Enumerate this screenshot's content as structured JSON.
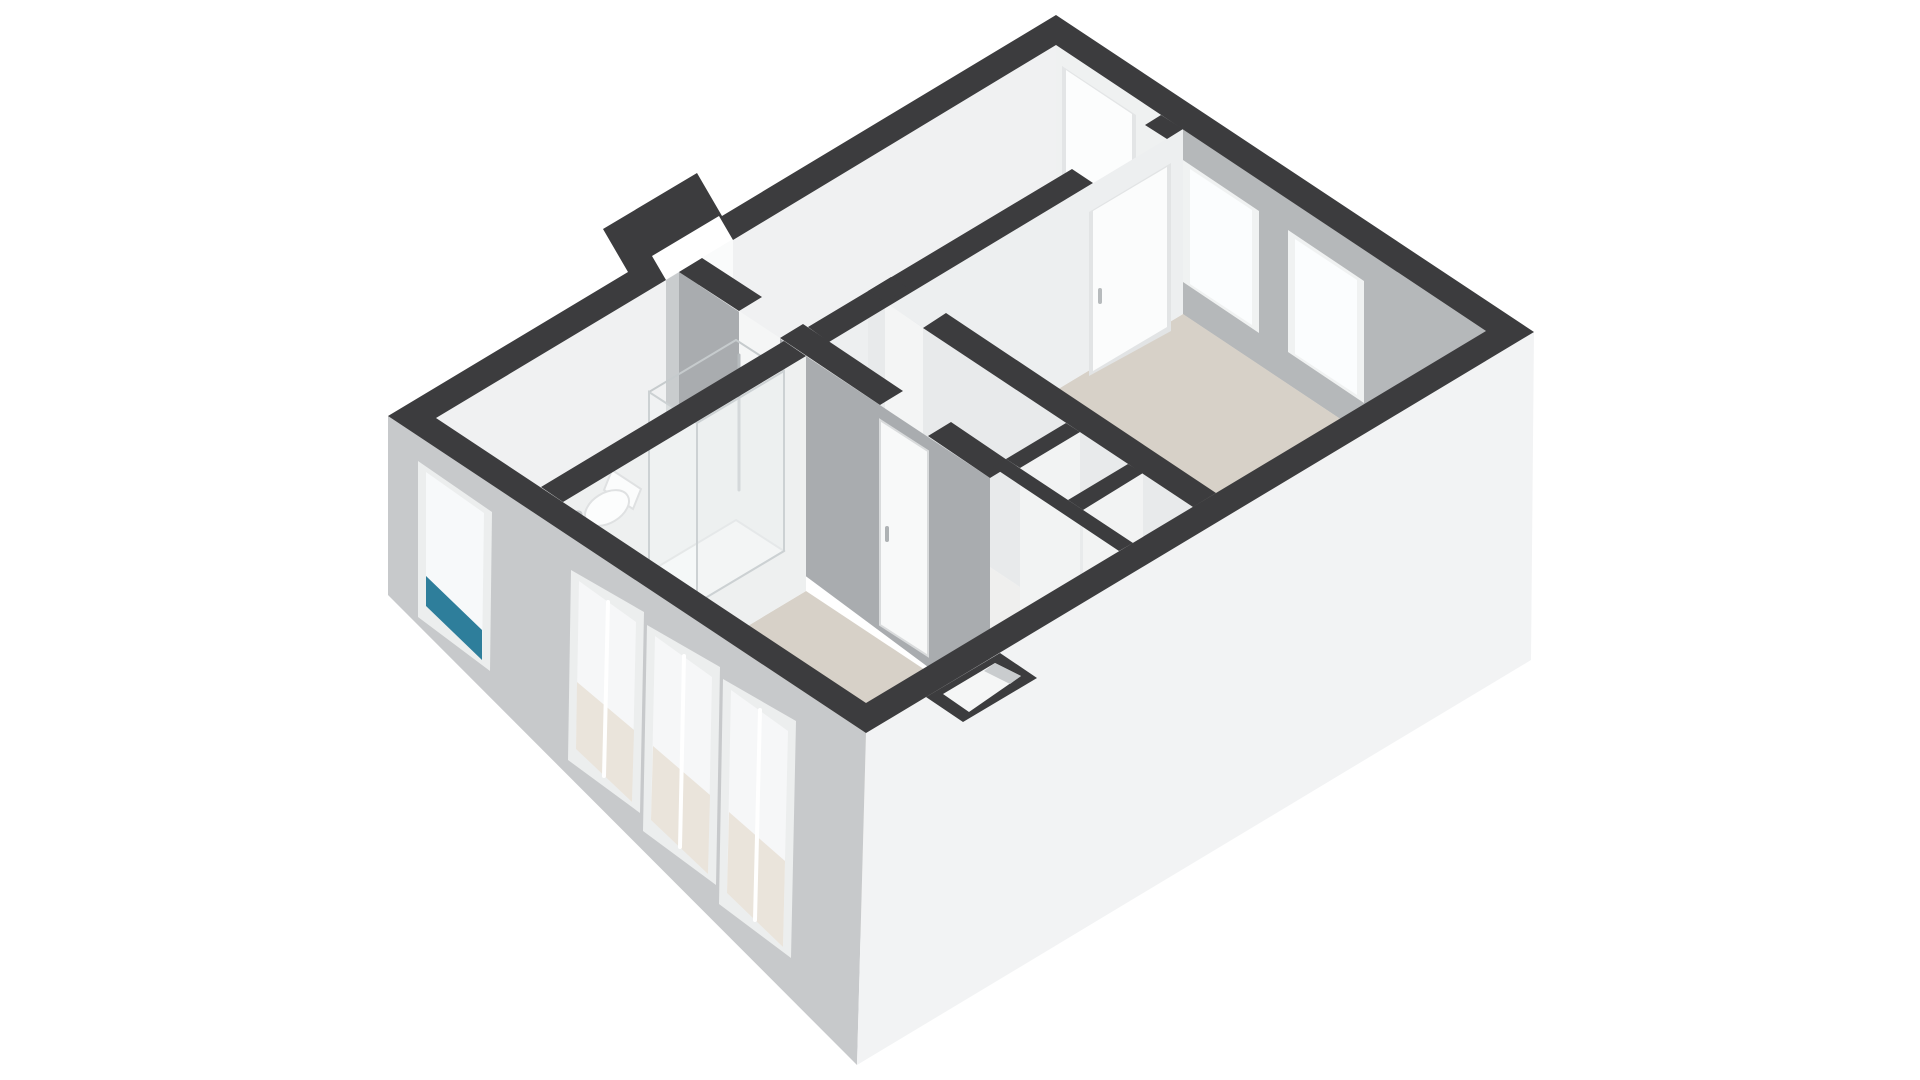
{
  "meta": {
    "description": "3D isometric floor plan render of a small apartment (two rooms, living room, bathroom with shower, bathtub and toilet), dark cut wall caps, beige floors, white background",
    "background": "#ffffff"
  },
  "colors": {
    "wall_cap": "#3c3c3e",
    "facade_shaded": "#c7c9cb",
    "facade_lit": "#f2f3f4",
    "inner_wall_lit": "#eff1f1",
    "inner_wall_shaded": "#aaadb0",
    "floor_beige": "#d7d1c8",
    "floor_white": "#f1f1f0",
    "window_frame": "#eceeee",
    "glass": "#f7f9fa",
    "accent_teal": "#2e7e9b",
    "door_leaf": "#fcfdfd"
  },
  "scene": {
    "width": 1920,
    "height": 1080,
    "shapes": [
      {
        "name": "nw-wall-inner-face",
        "type": "polygon",
        "points": "1056,45 436,418 436,628 1056,215",
        "fill": "#f0f1f2"
      },
      {
        "name": "nw-wall-niche-opening",
        "type": "polygon",
        "points": "733,239 666,280 666,460 733,419",
        "fill": "#fafbfb"
      },
      {
        "name": "nw-wall-niche-shade",
        "type": "polygon",
        "points": "699,260 666,280 666,460 699,440",
        "fill": "#c9ccce"
      },
      {
        "name": "ne-wall-inner-face-top-room",
        "type": "polygon",
        "points": "1056,45 1172,122 1172,292 1056,215",
        "fill": "#eff1f1"
      },
      {
        "name": "entrance-door-frame",
        "type": "polygon",
        "points": "1062,66 1136,115 1136,272 1062,223",
        "fill": "#e3e5e6"
      },
      {
        "name": "entrance-door-leaf",
        "type": "polygon",
        "points": "1066,70 1132,114 1132,266 1066,222",
        "fill": "#fcfdfd"
      },
      {
        "name": "ne-wall-inner-face-bedroom",
        "type": "polygon",
        "points": "1172,122 1486,331 1486,516 1172,307",
        "fill": "#b5b8ba"
      },
      {
        "name": "bedroom-window-1-frame",
        "type": "polygon",
        "points": "1183,160 1259,211 1259,333 1183,282",
        "fill": "#f0f2f2"
      },
      {
        "name": "bedroom-window-1-glass",
        "type": "polygon",
        "points": "1190,169 1252,210 1252,325 1190,284",
        "fill": "#fbfdfe"
      },
      {
        "name": "bedroom-window-2-frame",
        "type": "polygon",
        "points": "1288,230 1364,281 1364,403 1288,352",
        "fill": "#f0f2f2"
      },
      {
        "name": "bedroom-window-2-glass",
        "type": "polygon",
        "points": "1295,239 1357,280 1357,395 1295,354",
        "fill": "#fbfdfe"
      },
      {
        "name": "floor-top-room",
        "type": "polygon",
        "points": "1056,215 1161,285 808,497 702,428",
        "fill": "#f1f1f0"
      },
      {
        "name": "floor-bedroom",
        "type": "polygon",
        "points": "1183,314 1486,516 1216,678 913,476",
        "fill": "#d7d1c8"
      },
      {
        "name": "floor-hallway",
        "type": "polygon",
        "points": "868,486 1193,702 1133,738 808,522",
        "fill": "#efefee"
      },
      {
        "name": "floor-closet-1",
        "type": "polygon",
        "points": "1080,630 1128,662 1068,698 1020,666",
        "fill": "#f4f4f3"
      },
      {
        "name": "floor-closet-2",
        "type": "polygon",
        "points": "1143,671 1193,705 1133,741 1083,708",
        "fill": "#f4f4f3"
      },
      {
        "name": "floor-bathroom",
        "type": "polygon",
        "points": "679,482 784,551 541,697 436,628",
        "fill": "#f2f2f1"
      },
      {
        "name": "floor-living-room",
        "type": "polygon",
        "points": "806,591 1109,792 866,938 563,737",
        "fill": "#d7d1c8"
      },
      {
        "name": "bedroom-divider-wall-face",
        "type": "polygon",
        "points": "1183,129 829,342 829,527 1183,314",
        "fill": "#edeff0"
      },
      {
        "name": "bedroom-door-frame",
        "type": "polygon",
        "points": "1171,163 1089,212 1089,376 1171,331",
        "fill": "#e2e4e5"
      },
      {
        "name": "bedroom-door-leaf",
        "type": "polygon",
        "points": "1167,167 1093,211 1093,371 1167,327",
        "fill": "#fbfcfc"
      },
      {
        "name": "bedroom-door-handle",
        "type": "line",
        "x1": 1100,
        "y1": 290,
        "x2": 1100,
        "y2": 302,
        "stroke": "#b7bbbd",
        "sw": 4
      },
      {
        "name": "hall-bedroom-wall-face",
        "type": "polygon",
        "points": "868,291 1193,507 1193,702 868,486",
        "fill": "#e8eaeb"
      },
      {
        "name": "hall-bedroom-door-opening",
        "type": "polygon",
        "points": "885,302 923,328 923,523 885,497",
        "fill": "#f4f5f5"
      },
      {
        "name": "closet-divider-1-face",
        "type": "polygon",
        "points": "1080,432 1020,468 1020,666 1080,630",
        "fill": "#f2f3f3"
      },
      {
        "name": "closet-divider-2-face",
        "type": "polygon",
        "points": "1143,473 1083,510 1083,708 1143,671",
        "fill": "#f2f3f3"
      },
      {
        "name": "long-wall-shaded-face",
        "type": "polygon",
        "points": "679,272 990,478 990,713 679,482",
        "fill": "#a9acaf"
      },
      {
        "name": "hall-door-opening",
        "type": "polygon",
        "points": "739,311 780,338 780,558 739,531",
        "fill": "#f5f6f6"
      },
      {
        "name": "living-room-door-leaf",
        "type": "polygon",
        "points": "880,420 928,451 928,656 880,625",
        "fill": "#f8f9f9",
        "stroke": "#d9dbdc",
        "sw": 2
      },
      {
        "name": "living-room-door-handle",
        "type": "line",
        "x1": 887,
        "y1": 528,
        "x2": 887,
        "y2": 540,
        "stroke": "#aeb2b4",
        "sw": 4
      },
      {
        "name": "bathroom-living-wall-face",
        "type": "polygon",
        "points": "806,356 563,502 563,737 806,591",
        "fill": "#eef0f0"
      },
      {
        "name": "shower-tray",
        "type": "polygon",
        "points": "736,520 784,551 697,603 649,572",
        "fill": "#fafbfb",
        "stroke": "#dcdedf",
        "sw": 2
      },
      {
        "name": "bathtub-rim",
        "type": "polygon",
        "points": "552,498 641,556 537,618 449,560",
        "fill": "#fdfdfe",
        "stroke": "#dddfe0",
        "sw": 2
      },
      {
        "name": "bathtub-basin",
        "type": "polygon",
        "points": "563,512 627,554 539,605 470,559",
        "fill": "#f3f4f4"
      },
      {
        "name": "bathtub-towel-teal",
        "type": "polygon",
        "points": "449,560 537,618 529,631 441,573",
        "fill": "#2e7e9b"
      },
      {
        "name": "bathtub-faucet",
        "type": "ellipse",
        "cx": 576,
        "cy": 516,
        "rx": 7,
        "ry": 5,
        "rot": -31,
        "fill": "#c3c7c9"
      },
      {
        "name": "toilet-tank",
        "type": "polygon",
        "points": "612,470 641,489 633,509 604,490",
        "fill": "#fbfcfc",
        "stroke": "#dfe1e2",
        "sw": 2
      },
      {
        "name": "toilet-bowl",
        "type": "ellipse",
        "cx": 607,
        "cy": 508,
        "rx": 24,
        "ry": 15,
        "rot": -31,
        "fill": "#fcfdfd",
        "stroke": "#dfe1e2",
        "sw": 2
      },
      {
        "name": "shower-head-pole",
        "type": "line",
        "x1": 739,
        "y1": 355,
        "x2": 739,
        "y2": 490,
        "stroke": "#b6bbbe",
        "sw": 3
      },
      {
        "name": "shower-head",
        "type": "ellipse",
        "cx": 745,
        "cy": 372,
        "rx": 6,
        "ry": 5,
        "rot": 0,
        "fill": "#c9cdcf"
      },
      {
        "name": "shower-glass-rim-1",
        "type": "line",
        "x1": 736,
        "y1": 340,
        "x2": 784,
        "y2": 371,
        "stroke": "#c6cbcd",
        "sw": 2
      },
      {
        "name": "shower-glass-rim-2",
        "type": "line",
        "x1": 736,
        "y1": 340,
        "x2": 649,
        "y2": 392,
        "stroke": "#c6cbcd",
        "sw": 2
      },
      {
        "name": "shower-glass-front",
        "type": "polygon",
        "points": "784,371 697,423 697,603 784,551",
        "fill": "rgba(236,240,241,0.55)",
        "stroke": "#ccd1d3",
        "sw": 2
      },
      {
        "name": "shower-glass-side",
        "type": "polygon",
        "points": "649,392 697,423 697,603 649,572",
        "fill": "rgba(240,243,244,0.45)",
        "stroke": "#ccd1d3",
        "sw": 2
      },
      {
        "name": "sw-facade",
        "type": "polygon",
        "points": "388,416 866,733 857,1065 388,595",
        "fill": "#c7c9cb"
      },
      {
        "name": "bathroom-window-frame",
        "type": "polygon",
        "points": "418,461 492,512 490,671 418,617",
        "fill": "#eceeee"
      },
      {
        "name": "bathroom-window-glass",
        "type": "polygon",
        "points": "426,472 484,513 482,660 426,606",
        "fill": "#f7f9fa"
      },
      {
        "name": "bathroom-window-teal-accent",
        "type": "polygon",
        "points": "426,576 482,630 482,660 426,606",
        "fill": "#2e7e9b"
      },
      {
        "name": "living-window-1-frame",
        "type": "polygon",
        "points": "571,570 644,612 640,813 568,760",
        "fill": "#eceeee"
      },
      {
        "name": "living-window-1-glass",
        "type": "polygon",
        "points": "579,581 636,622 632,802 576,749",
        "fill": "#f6f7f8"
      },
      {
        "name": "living-window-1-floor-view",
        "type": "polygon",
        "points": "577,682 634,730 632,802 576,749",
        "fill": "#eae4db"
      },
      {
        "name": "living-window-1-mullion",
        "type": "line",
        "x1": 608,
        "y1": 602,
        "x2": 604,
        "y2": 776,
        "stroke": "#ffffff",
        "sw": 4
      },
      {
        "name": "living-window-2-frame",
        "type": "polygon",
        "points": "647,625 720,667 716,885 643,831",
        "fill": "#eceeee"
      },
      {
        "name": "living-window-2-glass",
        "type": "polygon",
        "points": "655,636 712,677 708,874 651,820",
        "fill": "#f6f7f8"
      },
      {
        "name": "living-window-2-floor-view",
        "type": "polygon",
        "points": "653,746 710,795 708,874 651,820",
        "fill": "#eae4db"
      },
      {
        "name": "living-window-2-mullion",
        "type": "line",
        "x1": 684,
        "y1": 656,
        "x2": 680,
        "y2": 847,
        "stroke": "#ffffff",
        "sw": 4
      },
      {
        "name": "living-window-3-frame",
        "type": "polygon",
        "points": "723,679 796,721 791,958 719,904",
        "fill": "#eceeee"
      },
      {
        "name": "living-window-3-glass",
        "type": "polygon",
        "points": "731,690 788,731 783,947 727,893",
        "fill": "#f6f7f8"
      },
      {
        "name": "living-window-3-floor-view",
        "type": "polygon",
        "points": "729,812 785,861 783,947 727,893",
        "fill": "#eae4db"
      },
      {
        "name": "living-window-3-mullion",
        "type": "line",
        "x1": 760,
        "y1": 710,
        "x2": 755,
        "y2": 920,
        "stroke": "#ffffff",
        "sw": 4
      },
      {
        "name": "se-facade",
        "type": "polygon",
        "points": "866,733 1534,332 1531,660 857,1065",
        "fill": "#f2f3f4"
      },
      {
        "name": "se-niche-cap",
        "type": "polygon",
        "points": "1000,653 1037,678 963,722 926,697",
        "fill": "#3c3c3e"
      },
      {
        "name": "se-niche-inner",
        "type": "polygon",
        "points": "995,663 1021,676 969,712 943,694",
        "fill": "#f5f6f6"
      },
      {
        "name": "se-niche-inner-shade",
        "type": "polygon",
        "points": "995,663 1021,676 1010,684 984,671",
        "fill": "#c9ccce"
      },
      {
        "name": "perimeter-wall-cap",
        "type": "path",
        "d": "M 1056,15 L 722,216 L 697,173 L 603,229 L 628,272 L 388,416 L 866,733 L 1534,332 Z M 1056,45 L 733,240 L 719,216 L 652,256 L 666,280 L 436,418 L 866,703 L 1486,331 Z",
        "fill": "#3c3c3e"
      },
      {
        "name": "bedroom-divider-cap-1",
        "type": "polygon",
        "points": "1161,115 1183,129 1167,139 1145,125",
        "fill": "#3c3c3e"
      },
      {
        "name": "bedroom-divider-cap-2",
        "type": "polygon",
        "points": "1072,169 1093,183 829,342 808,327",
        "fill": "#3c3c3e"
      },
      {
        "name": "hall-bedroom-wall-cap-1",
        "type": "polygon",
        "points": "891,277 908,288 885,302 868,291",
        "fill": "#3c3c3e"
      },
      {
        "name": "hall-bedroom-wall-cap-2",
        "type": "polygon",
        "points": "946,313 1216,493 1193,507 923,328",
        "fill": "#3c3c3e"
      },
      {
        "name": "long-wall-cap-1",
        "type": "polygon",
        "points": "702,258 762,297 739,311 679,272",
        "fill": "#3c3c3e"
      },
      {
        "name": "long-wall-cap-2",
        "type": "polygon",
        "points": "803,324 903,391 880,405 780,338",
        "fill": "#3c3c3e"
      },
      {
        "name": "long-wall-cap-3",
        "type": "polygon",
        "points": "951,422 1013,464 990,478 928,436",
        "fill": "#3c3c3e"
      },
      {
        "name": "bathroom-living-wall-cap",
        "type": "polygon",
        "points": "784,341 806,356 563,502 541,487",
        "fill": "#3c3c3e"
      },
      {
        "name": "closet-front-cap",
        "type": "polygon",
        "points": "1006,459 1133,543 1119,551 993,467",
        "fill": "#3c3c3e"
      },
      {
        "name": "closet-divider-1-cap",
        "type": "polygon",
        "points": "1066,423 1080,432 1020,468 1006,459",
        "fill": "#3c3c3e"
      },
      {
        "name": "closet-divider-2-cap",
        "type": "polygon",
        "points": "1128,464 1143,473 1083,510 1068,500",
        "fill": "#3c3c3e"
      }
    ]
  }
}
